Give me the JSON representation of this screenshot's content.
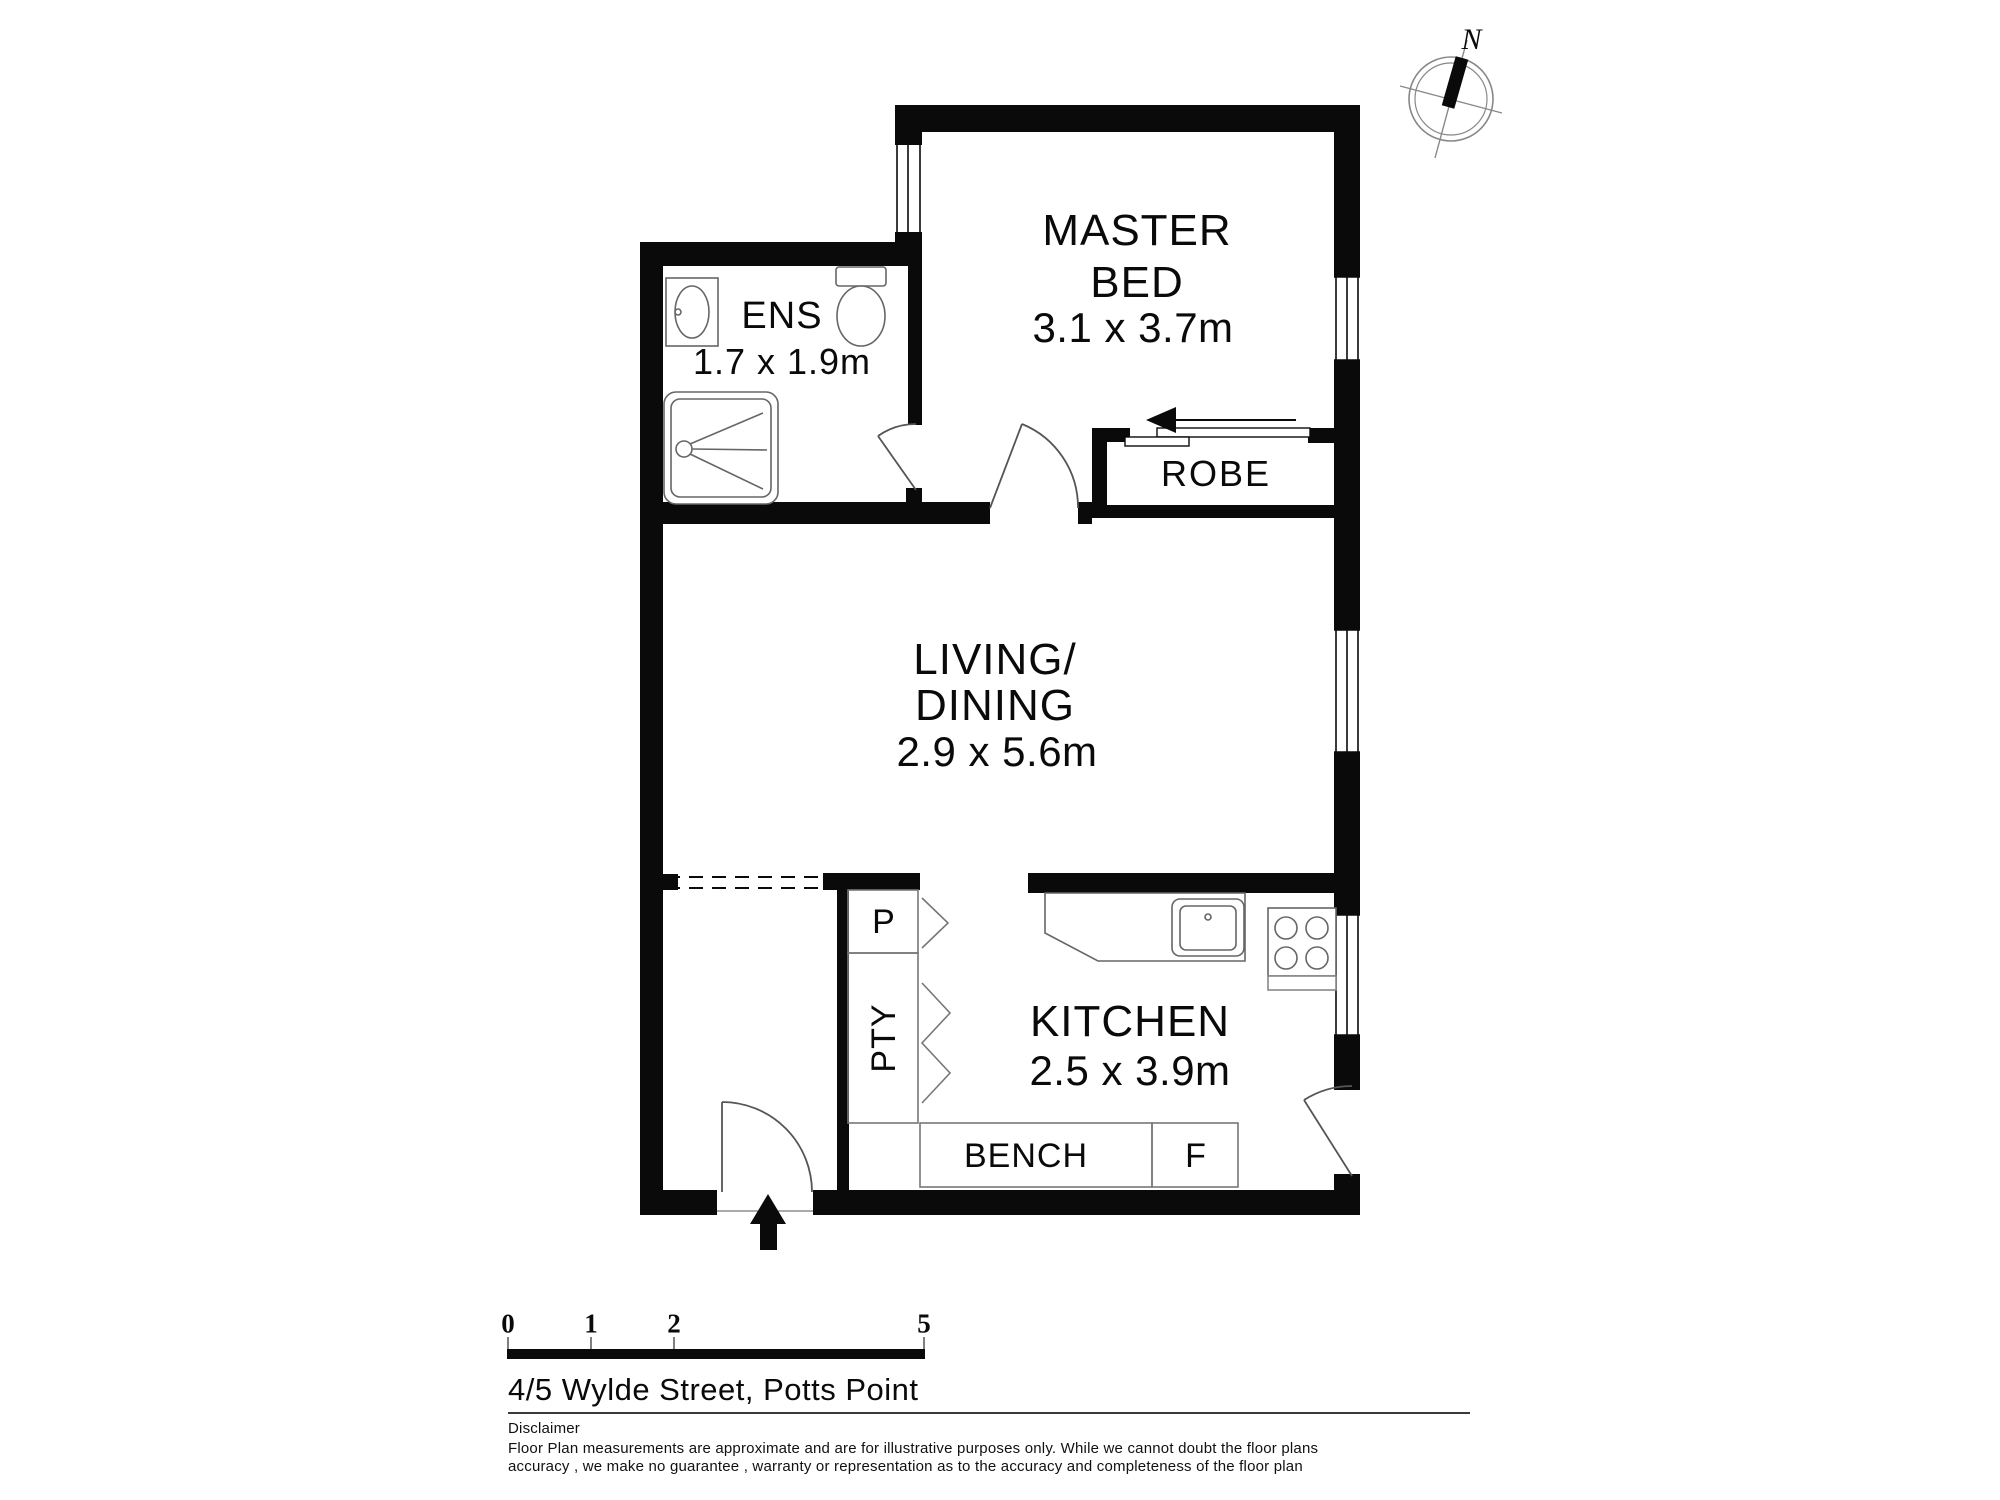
{
  "page": {
    "background": "#ffffff",
    "ink": "#000000",
    "fixture_line": "#666666"
  },
  "compass": {
    "north_label": "N"
  },
  "rooms": {
    "master_bed": {
      "line1": "MASTER",
      "line2": "BED",
      "dims": "3.1 x 3.7m"
    },
    "ens": {
      "name": "ENS",
      "dims": "1.7 x 1.9m"
    },
    "robe": {
      "name": "ROBE"
    },
    "living_dining": {
      "line1": "LIVING/",
      "line2": "DINING",
      "dims": "2.9 x 5.6m"
    },
    "kitchen": {
      "name": "KITCHEN",
      "dims": "2.5 x 3.9m"
    }
  },
  "cabinetry": {
    "pantry_top": "P",
    "pantry": "PTY",
    "bench": "BENCH",
    "fridge": "F"
  },
  "scale_bar": {
    "tick0": "0",
    "tick1": "1",
    "tick2": "2",
    "tick5": "5"
  },
  "footer": {
    "address": "4/5 Wylde Street, Potts Point",
    "disclaimer_heading": "Disclaimer",
    "disclaimer_line1": "Floor Plan measurements are approximate and are for illustrative purposes only. While we cannot doubt the floor plans",
    "disclaimer_line2": "accuracy , we make no guarantee , warranty or representation as to the accuracy and completeness of the floor plan"
  }
}
